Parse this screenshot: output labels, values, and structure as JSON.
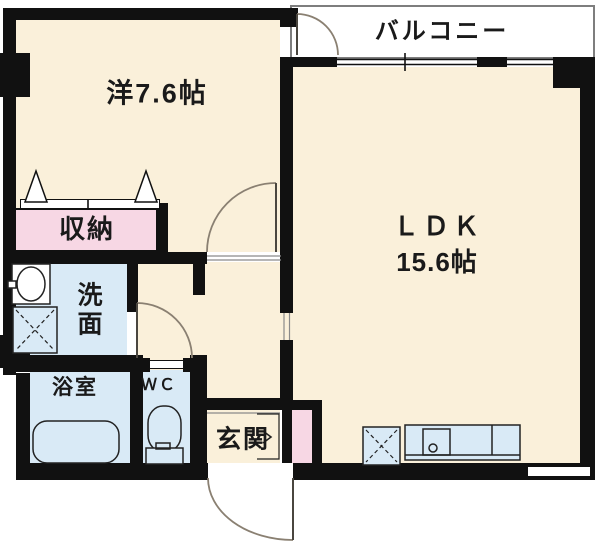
{
  "plan_type": "floorplan",
  "rooms": {
    "western": {
      "name": "洋7.6帖"
    },
    "balcony": {
      "name": "バルコニー"
    },
    "ldk": {
      "name": "ＬＤＫ",
      "size": "15.6帖"
    },
    "storage": {
      "name": "収納"
    },
    "washroom": {
      "name": "洗面",
      "line1": "洗",
      "line2": "面"
    },
    "bathroom": {
      "name": "浴室"
    },
    "wc": {
      "name": "ＷＣ"
    },
    "entrance": {
      "name": "玄関"
    }
  },
  "fixtures": {
    "washbasin": "washbasin-icon",
    "washing_machine_space": "washing-machine-space-icon",
    "bathtub": "bathtub-icon",
    "toilet": "toilet-icon",
    "kitchen_counter": "kitchen-counter-icon",
    "kitchen_sink": "kitchen-sink-icon",
    "appliance_space": "appliance-space-icon",
    "closet_folding_doors": "folding-door-icon",
    "swing_doors": "swing-door-arc-icon",
    "sliding_windows": "sliding-window-icon",
    "entrance_step_arrow": "entrance-direction-arrow-icon"
  },
  "colors": {
    "floor": "#faf0da",
    "wet": "#d9eaf6",
    "pink": "#f7d7e4",
    "wall": "#111111",
    "balcony_border": "#7e7e7e",
    "door_arc": "#8a8072",
    "fixture_line": "#222222",
    "text": "#1a1a1a"
  }
}
